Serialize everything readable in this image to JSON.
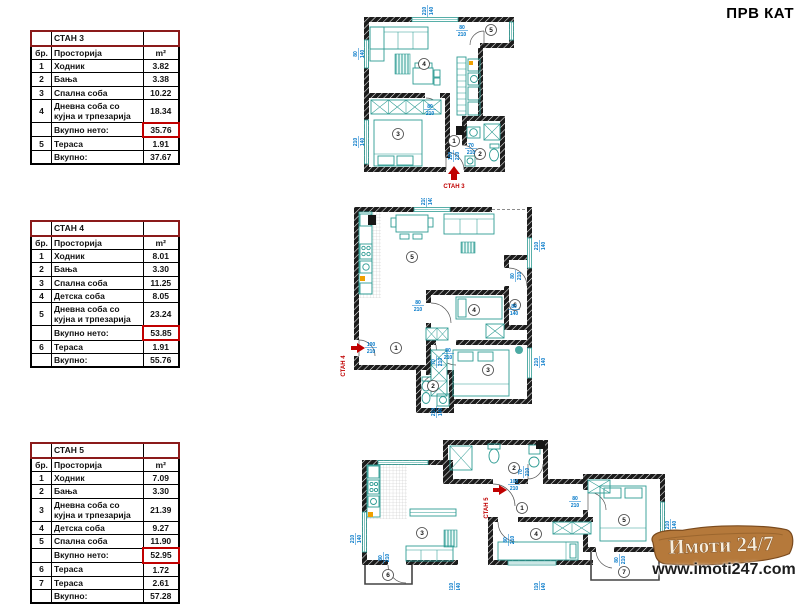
{
  "page": {
    "title": "ПРВ КАТ"
  },
  "watermark": {
    "brand": "Имоти 24/7",
    "url": "www.imoti247.com",
    "banner_color": "#b5793b"
  },
  "colors": {
    "accent_red": "#C00000",
    "furniture_teal": "#2D9B93",
    "dimension_blue": "#0077C8",
    "wall_black": "#1C1C1C"
  },
  "tables": [
    {
      "name": "СТАН 3",
      "headers": {
        "num": "бр.",
        "room": "Просторија",
        "area": "m²"
      },
      "rows": [
        {
          "num": "1",
          "room": "Ходник",
          "area": "3.82"
        },
        {
          "num": "2",
          "room": "Бања",
          "area": "3.38"
        },
        {
          "num": "3",
          "room": "Спална соба",
          "area": "10.22"
        },
        {
          "num": "4",
          "room": "Дневна соба со кујна и трпезарија",
          "area": "18.34"
        }
      ],
      "net": {
        "label": "Вкупно нето:",
        "value": "35.76"
      },
      "rows2": [
        {
          "num": "5",
          "room": "Тераса",
          "area": "1.91"
        }
      ],
      "total": {
        "label": "Вкупно:",
        "value": "37.67"
      }
    },
    {
      "name": "СТАН 4",
      "headers": {
        "num": "бр.",
        "room": "Просторија",
        "area": "m²"
      },
      "rows": [
        {
          "num": "1",
          "room": "Ходник",
          "area": "8.01"
        },
        {
          "num": "2",
          "room": "Бања",
          "area": "3.30"
        },
        {
          "num": "3",
          "room": "Спална соба",
          "area": "11.25"
        },
        {
          "num": "4",
          "room": "Детска соба",
          "area": "8.05"
        },
        {
          "num": "5",
          "room": "Дневна соба со кујна и трпезарија",
          "area": "23.24"
        }
      ],
      "net": {
        "label": "Вкупно нето:",
        "value": "53.85"
      },
      "rows2": [
        {
          "num": "6",
          "room": "Тераса",
          "area": "1.91"
        }
      ],
      "total": {
        "label": "Вкупно:",
        "value": "55.76"
      }
    },
    {
      "name": "СТАН 5",
      "headers": {
        "num": "бр.",
        "room": "Просторија",
        "area": "m²"
      },
      "rows": [
        {
          "num": "1",
          "room": "Ходник",
          "area": "7.09"
        },
        {
          "num": "2",
          "room": "Бања",
          "area": "3.30"
        },
        {
          "num": "3",
          "room": "Дневна соба со кујна и трпезарија",
          "area": "21.39"
        },
        {
          "num": "4",
          "room": "Детска соба",
          "area": "9.27"
        },
        {
          "num": "5",
          "room": "Спална соба",
          "area": "11.90"
        }
      ],
      "net": {
        "label": "Вкупно нето:",
        "value": "52.95"
      },
      "rows2": [
        {
          "num": "6",
          "room": "Тераса",
          "area": "1.72"
        },
        {
          "num": "7",
          "room": "Тераса",
          "area": "2.61"
        }
      ],
      "total": {
        "label": "Вкупно:",
        "value": "57.28"
      }
    }
  ],
  "plans": [
    {
      "label": "СТАН 3",
      "rooms": [
        "1",
        "2",
        "3",
        "4",
        "5"
      ],
      "dims": [
        {
          "w": "210",
          "h": "140"
        },
        {
          "w": "80",
          "h": "140"
        },
        {
          "w": "210",
          "h": "140"
        },
        {
          "w": "80",
          "h": "210"
        },
        {
          "w": "80",
          "h": "210"
        },
        {
          "w": "100",
          "h": "210"
        },
        {
          "w": "70",
          "h": "210"
        }
      ]
    },
    {
      "label": "СТАН 4",
      "rooms": [
        "1",
        "2",
        "3",
        "4",
        "5",
        "6"
      ],
      "dims": [
        {
          "w": "210",
          "h": "140"
        },
        {
          "w": "210",
          "h": "140"
        },
        {
          "w": "80",
          "h": "210"
        },
        {
          "w": "80",
          "h": "140"
        },
        {
          "w": "80",
          "h": "210"
        },
        {
          "w": "80",
          "h": "210"
        },
        {
          "w": "70",
          "h": "210"
        },
        {
          "w": "210",
          "h": "140"
        },
        {
          "w": "100",
          "h": "210"
        },
        {
          "w": "210",
          "h": "140"
        }
      ]
    },
    {
      "label": "СТАН 5",
      "rooms": [
        "1",
        "2",
        "3",
        "4",
        "5",
        "6",
        "7"
      ],
      "dims": [
        {
          "w": "100",
          "h": "210"
        },
        {
          "w": "70",
          "h": "210"
        },
        {
          "w": "80",
          "h": "210"
        },
        {
          "w": "80",
          "h": "210"
        },
        {
          "w": "210",
          "h": "140"
        },
        {
          "w": "80",
          "h": "210"
        },
        {
          "w": "80",
          "h": "210"
        },
        {
          "w": "210",
          "h": "140"
        },
        {
          "w": "210",
          "h": "140"
        },
        {
          "w": "210",
          "h": "140"
        }
      ]
    }
  ]
}
